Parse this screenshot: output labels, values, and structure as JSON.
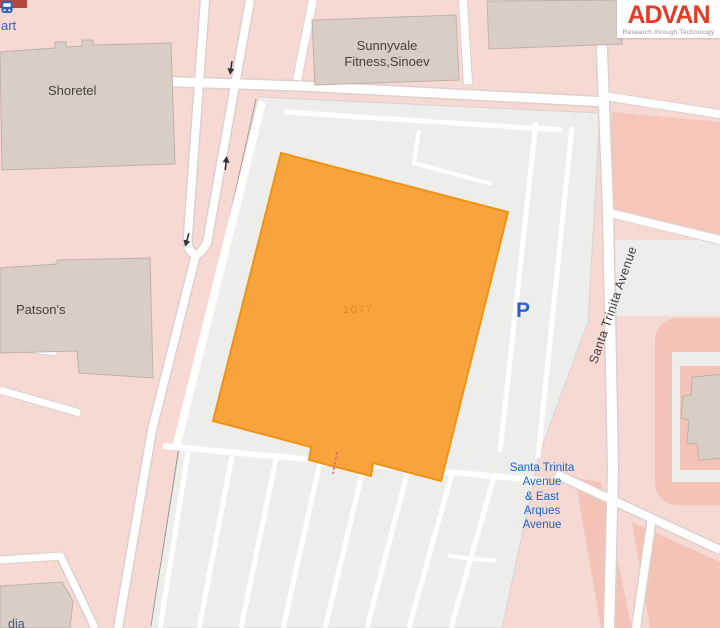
{
  "logo": {
    "brand": "ADVAN",
    "tagline": "Research through Technology",
    "brand_color": "#e23b26"
  },
  "map": {
    "labels": {
      "partial_top_left": "art",
      "shoretel": "Shoretel",
      "patsons": "Patson's",
      "sunnyvale_line1": "Sunnyvale",
      "sunnyvale_line2": "Fitness,Sinoev",
      "building_number": "1077",
      "parking": "P",
      "street": "Santa Trinita Avenue",
      "bus_stop_lines": [
        "Santa Trinita",
        "Avenue",
        "& East",
        "Arques",
        "Avenue"
      ],
      "partial_bottom_left": "dia"
    },
    "colors": {
      "background_pink": "#f7d9d4",
      "salmon": "#f6c6ba",
      "parking_lot_gray": "#ededeb",
      "building_tan": "#d9cec6",
      "building_border": "#bfb1a7",
      "highlight_orange": "#f8a33b",
      "highlight_border": "#ee9314",
      "road_white": "#ffffff",
      "bus_blue": "#1a63c8",
      "parking_blue": "#2f62c8",
      "label_dark": "#494139",
      "red_building": "#b5473e"
    }
  }
}
